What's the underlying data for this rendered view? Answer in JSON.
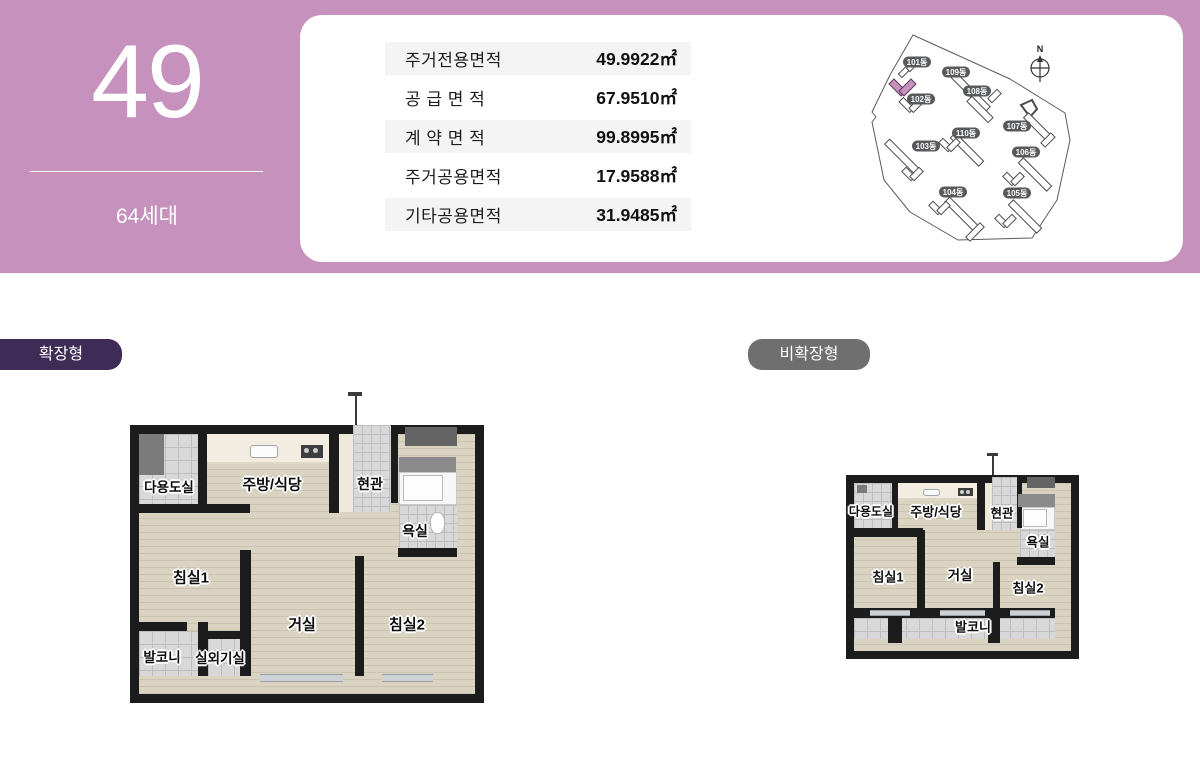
{
  "banner": {
    "unit_number": "49",
    "household_count": "64세대",
    "background_color": "#c791be"
  },
  "area_table": {
    "rows": [
      {
        "label": "주거전용면적",
        "value": "49.9922㎡"
      },
      {
        "label": "공 급 면 적",
        "value": "67.9510㎡"
      },
      {
        "label": "계 약 면 적",
        "value": "99.8995㎡"
      },
      {
        "label": "주거공용면적",
        "value": "17.9588㎡"
      },
      {
        "label": "기타공용면적",
        "value": "31.9485㎡"
      }
    ]
  },
  "site_map": {
    "compass_label": "N",
    "highlighted_building": "101동",
    "highlight_color": "#c791be",
    "buildings": [
      "101동",
      "102동",
      "103동",
      "104동",
      "105동",
      "106동",
      "107동",
      "108동",
      "109동",
      "110동"
    ]
  },
  "plan_types": {
    "expanded": {
      "label": "확장형",
      "badge_color": "#3e2b56"
    },
    "non_expanded": {
      "label": "비확장형",
      "badge_color": "#6f6f6f"
    }
  },
  "rooms": {
    "utility": "다용도실",
    "kitchen_dining": "주방/식당",
    "entrance": "현관",
    "bathroom": "욕실",
    "bedroom1": "침실1",
    "living": "거실",
    "bedroom2": "침실2",
    "balcony": "발코니",
    "ac_room": "실외기실"
  }
}
